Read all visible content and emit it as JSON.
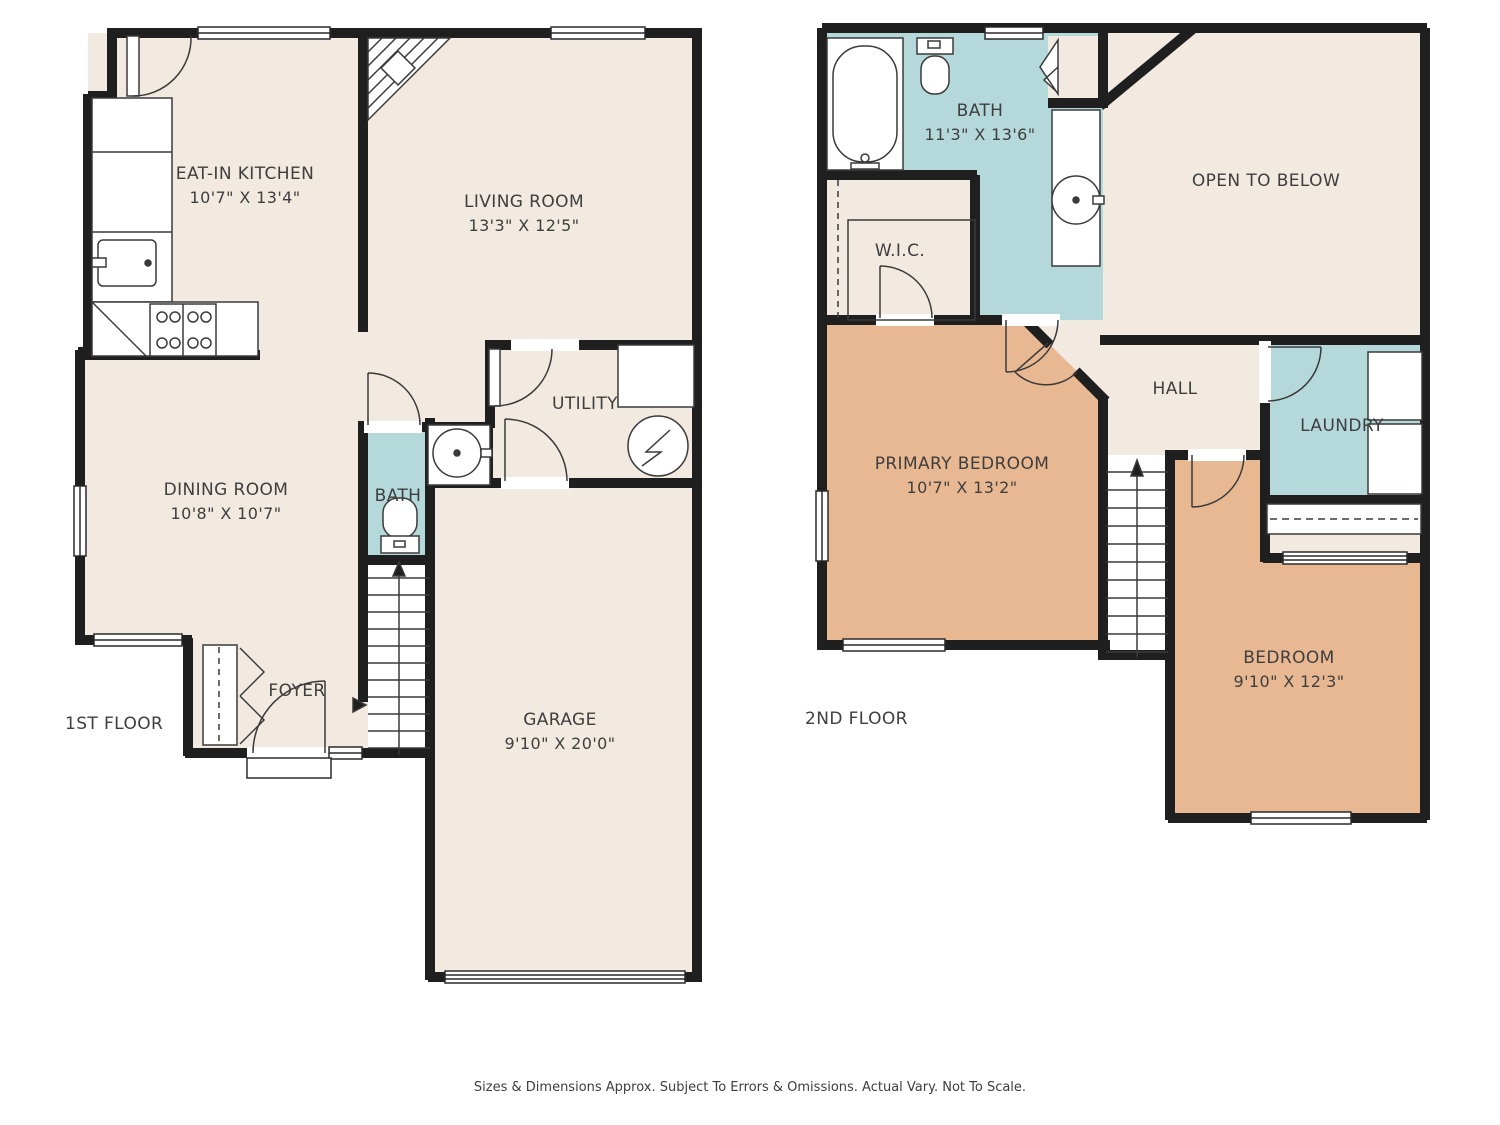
{
  "colors": {
    "room_fill": "#f2e9e1",
    "bedroom_fill": "#e8b893",
    "bath_fill": "#b5d8da",
    "wall": "#1f1f1f",
    "text": "#3e3e3e",
    "background": "#ffffff"
  },
  "floor1": {
    "title": "1ST FLOOR",
    "rooms": {
      "kitchen": {
        "name": "EAT-IN KITCHEN",
        "dims": "10'7\" X 13'4\""
      },
      "living": {
        "name": "LIVING ROOM",
        "dims": "13'3\" X 12'5\""
      },
      "dining": {
        "name": "DINING ROOM",
        "dims": "10'8\" X 10'7\""
      },
      "utility": {
        "name": "UTILITY"
      },
      "bath": {
        "name": "BATH"
      },
      "foyer": {
        "name": "FOYER"
      },
      "garage": {
        "name": "GARAGE",
        "dims": "9'10\" X 20'0\""
      }
    }
  },
  "floor2": {
    "title": "2ND FLOOR",
    "rooms": {
      "bath": {
        "name": "BATH",
        "dims": "11'3\" X 13'6\""
      },
      "wic": {
        "name": "W.I.C."
      },
      "open_below": {
        "name": "OPEN TO BELOW"
      },
      "primary": {
        "name": "PRIMARY BEDROOM",
        "dims": "10'7\" X 13'2\""
      },
      "hall": {
        "name": "HALL"
      },
      "laundry": {
        "name": "LAUNDRY"
      },
      "bedroom": {
        "name": "BEDROOM",
        "dims": "9'10\" X 12'3\""
      }
    }
  },
  "footer": {
    "disclaimer": "Sizes & Dimensions Approx. Subject To Errors & Omissions. Actual Vary. Not To Scale."
  }
}
